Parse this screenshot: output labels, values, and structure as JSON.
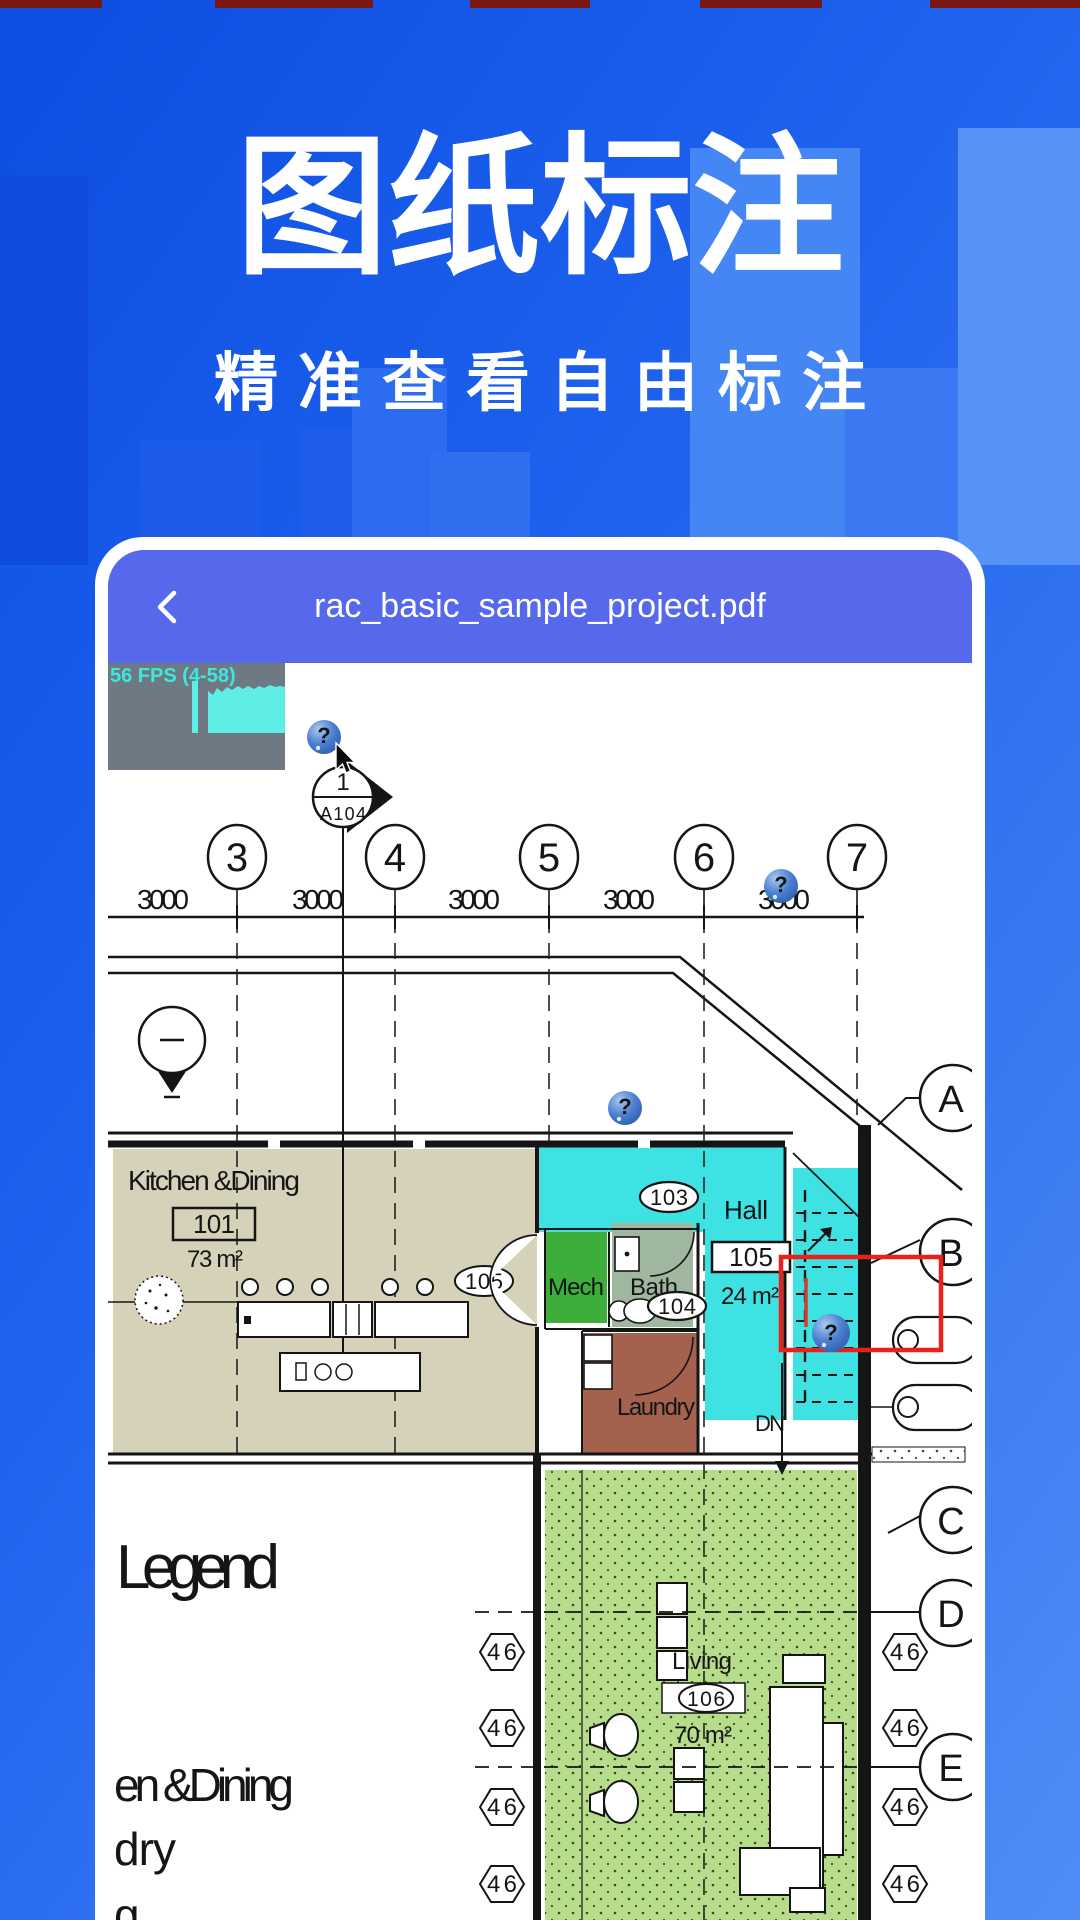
{
  "top_banner": {
    "title": "图纸标注",
    "subtitle": "精准查看自由标注"
  },
  "viewer": {
    "filename": "rac_basic_sample_project.pdf"
  },
  "fps_overlay": {
    "label": "56 FPS (4-58)"
  },
  "plan": {
    "grid_columns": [
      "3",
      "4",
      "5",
      "6",
      "7"
    ],
    "grid_rows": [
      "A",
      "B",
      "C",
      "D",
      "E"
    ],
    "dim_label": "3000",
    "section_marker": {
      "detail": "1",
      "sheet": "A104"
    },
    "rooms": {
      "kitchen": {
        "label": "Kitchen &Dining",
        "tag": "101",
        "area": "73 m²"
      },
      "hall": {
        "label": "Hall",
        "tag": "105",
        "area": "24 m²"
      },
      "mech": {
        "label": "Mech"
      },
      "bath": {
        "label": "Bath"
      },
      "laundry": {
        "label": "Laundry"
      },
      "living": {
        "label": "Living",
        "tag": "106",
        "area": "70 m²"
      }
    },
    "door_tags": {
      "d105": "105",
      "r103": "103",
      "r104": "104"
    },
    "stairs": {
      "down_label": "DN"
    },
    "hex_tag_label": "46",
    "question_marker": "?"
  },
  "legend": {
    "title": "Legend",
    "items": [
      "en &Dining",
      "dry",
      "g"
    ]
  },
  "colors": {
    "accent_red": "#e8211a",
    "cyan_room": "#3fe2e2",
    "tan_room": "#d6d2ba",
    "green_room": "#3dae3a",
    "sage_room": "#9eb79e",
    "brick_room": "#a4614e",
    "landscape": "#b7dc8b",
    "header_blue": "#5668ec",
    "fps_text": "#3ce8de"
  }
}
